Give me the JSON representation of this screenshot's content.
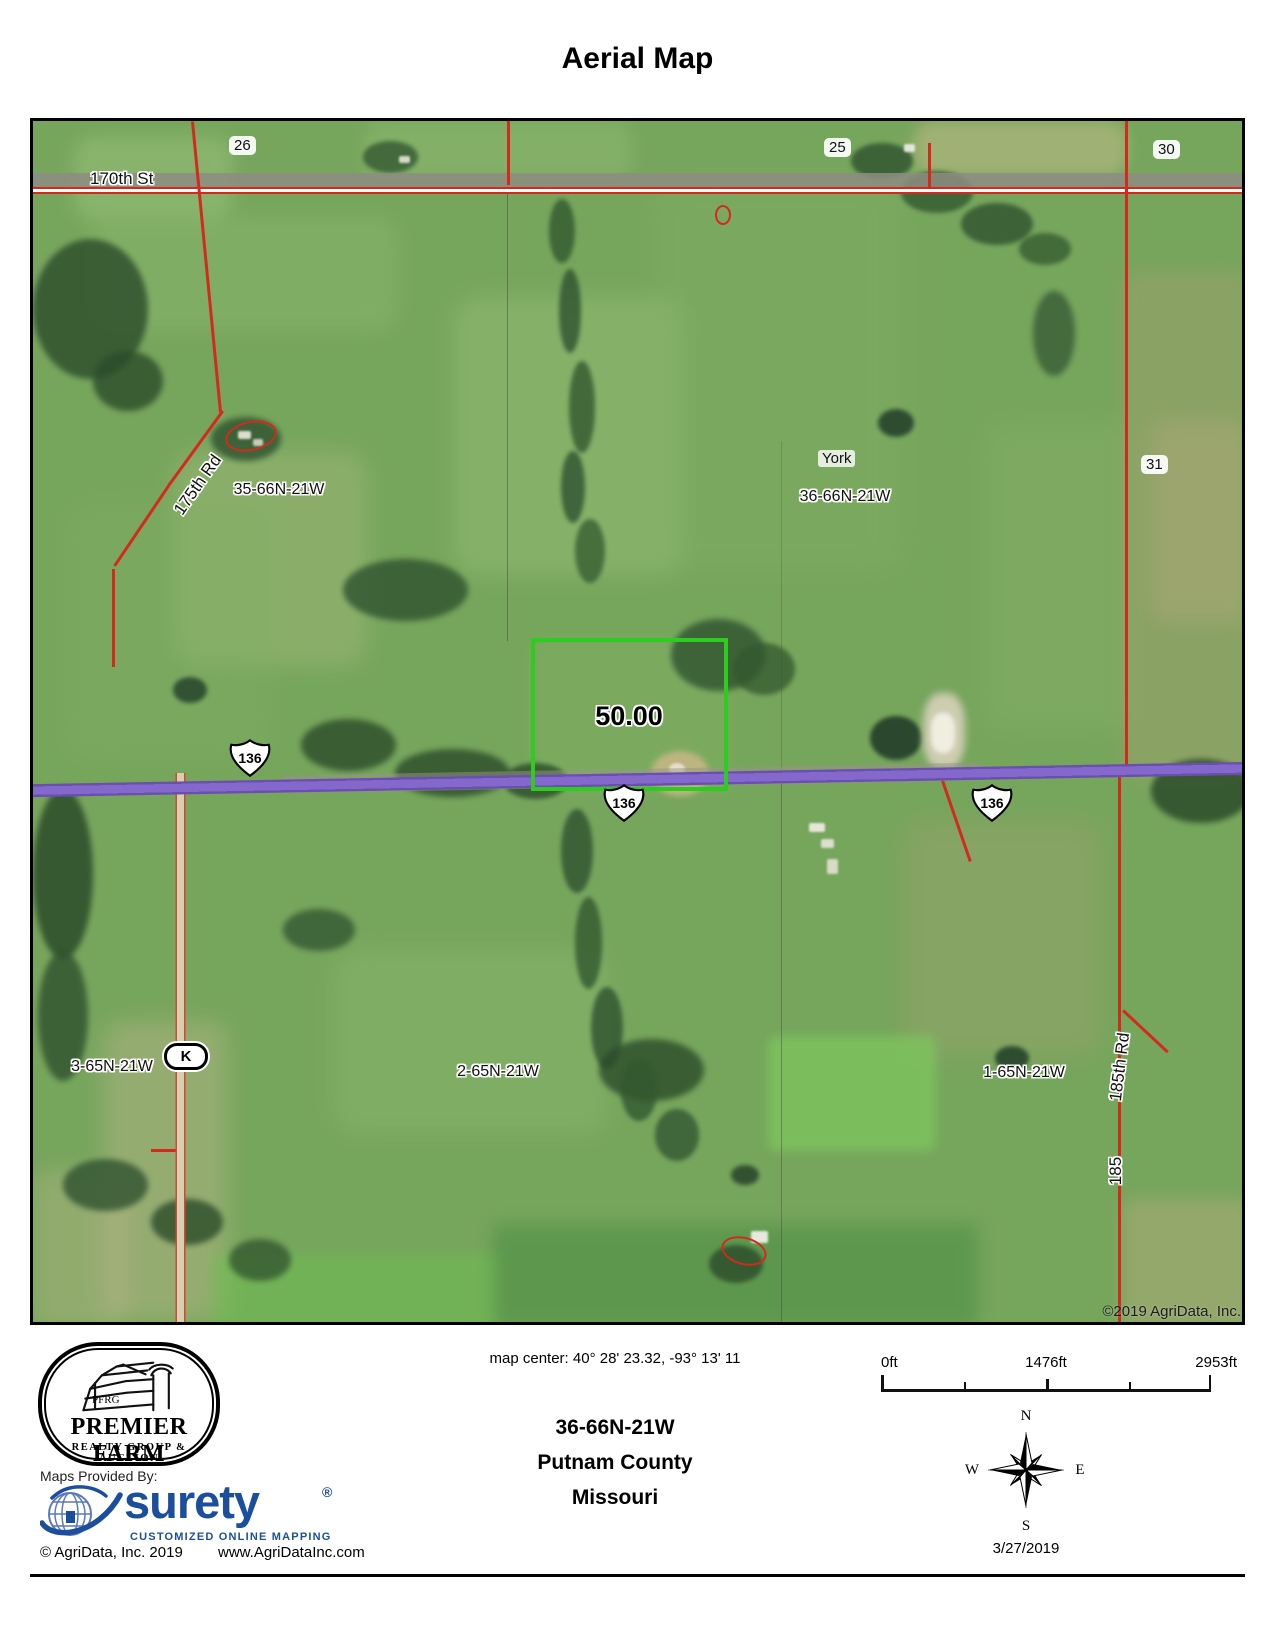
{
  "title": "Aerial Map",
  "map": {
    "labels": {
      "sec26": "26",
      "sec25": "25",
      "sec30": "30",
      "sec31": "31",
      "road_170th": "170th St",
      "road_175th": "175th Rd",
      "road_185th": "185th Rd",
      "road_185": "185",
      "twp35": "35-66N-21W",
      "twp36": "36-66N-21W",
      "york": "York",
      "sec3_65": "3-65N-21W",
      "sec2_65": "2-65N-21W",
      "sec1_65": "1-65N-21W",
      "parcel_acres": "50.00",
      "hwy136": "136",
      "route_k": "K",
      "copyright": "©2019 AgriData, Inc."
    },
    "colors": {
      "highway_purple": "#8468cc",
      "road_red": "#d42a1e",
      "parcel_green": "#2ecc1f",
      "route_tan": "#d9ceb2"
    }
  },
  "footer": {
    "pfrg": {
      "monogram": "PFRG",
      "name": "PREMIER FARM",
      "tagline": "REALTY GROUP & AUCTION"
    },
    "maps_provided_by": "Maps Provided By:",
    "surety": {
      "name": "surety",
      "registered": "®",
      "tagline": "CUSTOMIZED ONLINE MAPPING",
      "color": "#1c4e9e"
    },
    "agridata_copyright": "© AgriData, Inc. 2019",
    "agridata_url": "www.AgriDataInc.com",
    "map_center": "map center: 40° 28' 23.32,  -93° 13' 11",
    "township": "36-66N-21W",
    "county": "Putnam County",
    "state": "Missouri",
    "scale": {
      "start": "0ft",
      "mid": "1476ft",
      "end": "2953ft"
    },
    "compass": {
      "n": "N",
      "s": "S",
      "e": "E",
      "w": "W"
    },
    "date": "3/27/2019"
  }
}
